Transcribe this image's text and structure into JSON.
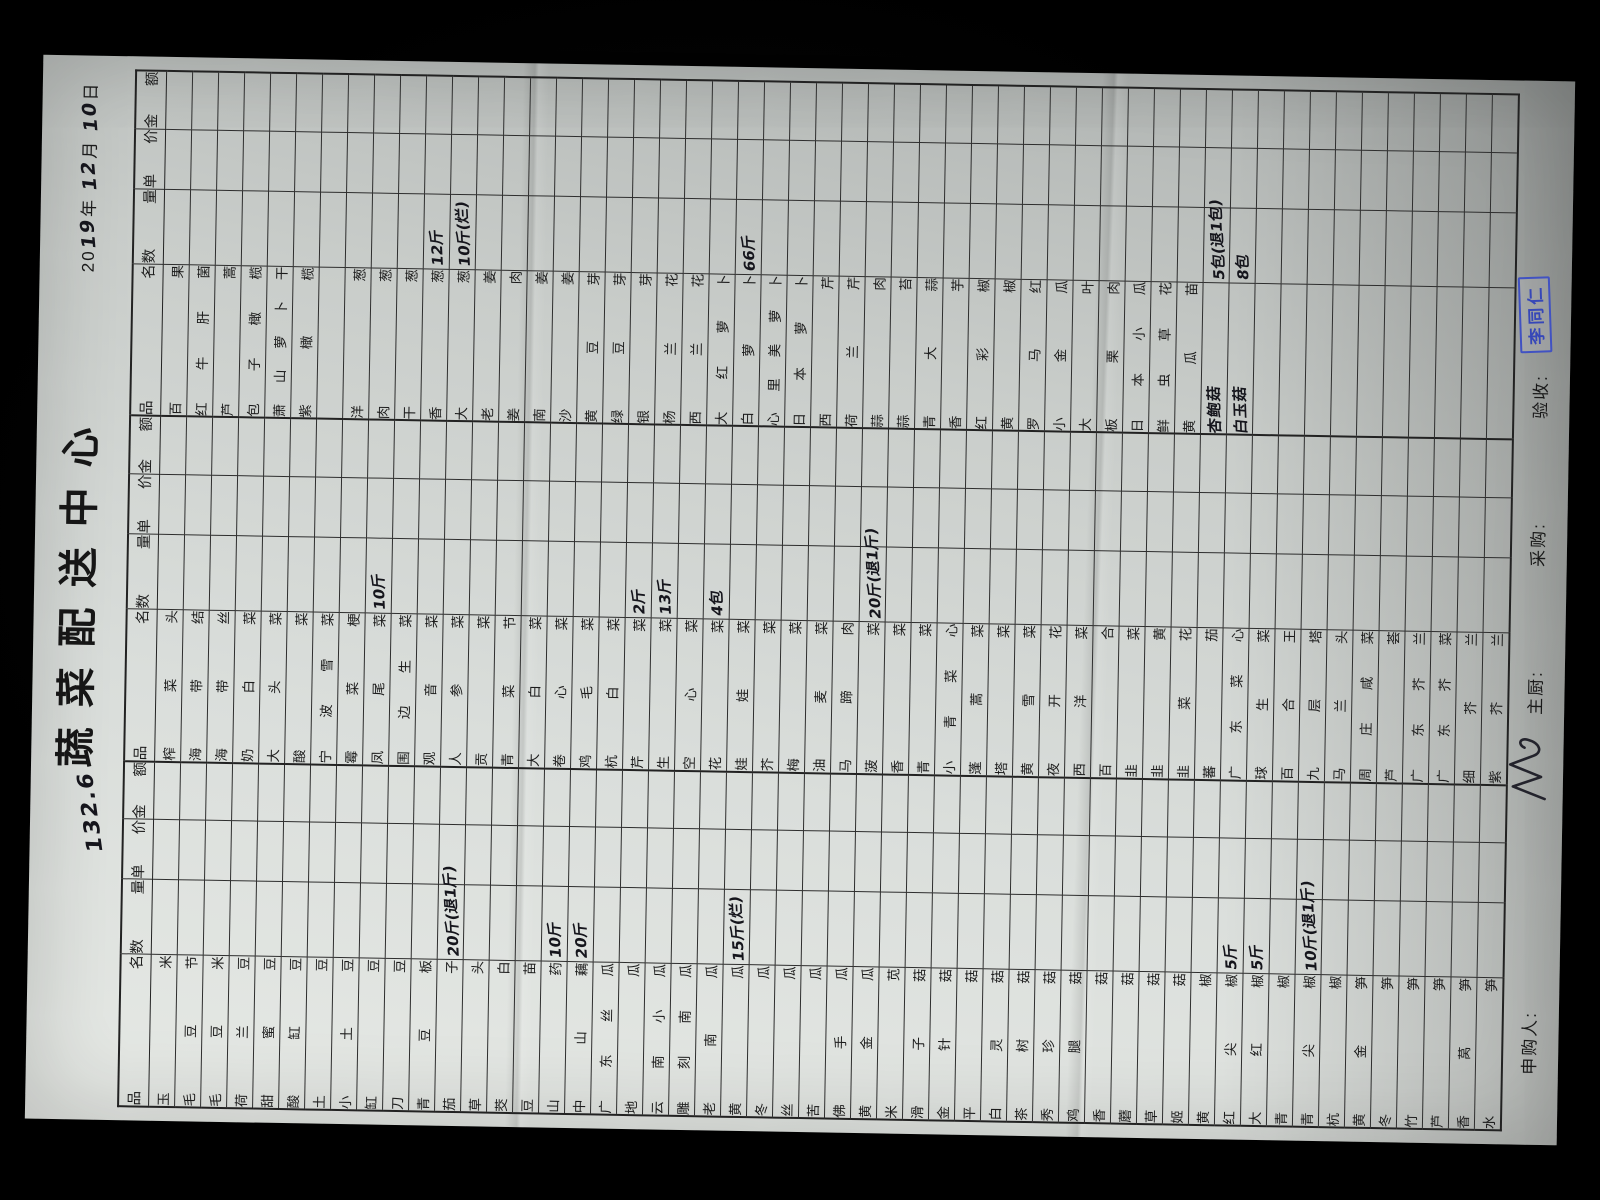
{
  "page": {
    "title": "蔬菜配送中心",
    "date": {
      "prefix": "20",
      "year_hw": "19",
      "year_unit": "年",
      "month_hw": "12",
      "month_unit": "月",
      "day_hw": "10",
      "day_unit": "日"
    },
    "total_hw": "132.6"
  },
  "table": {
    "headers": {
      "name": "品 名",
      "qty": "数量",
      "price": "单价",
      "amount": "金额"
    },
    "groups": [
      {
        "rows": [
          {
            "name": "玉米"
          },
          {
            "name": "毛豆节"
          },
          {
            "name": "毛豆米"
          },
          {
            "name": "荷兰豆"
          },
          {
            "name": "甜蜜豆"
          },
          {
            "name": "酸缸豆"
          },
          {
            "name": "土豆"
          },
          {
            "name": "小土豆"
          },
          {
            "name": "缸豆"
          },
          {
            "name": "刀豆"
          },
          {
            "name": "青豆板"
          },
          {
            "name": "茄子",
            "qty": "20斤(退1斤)"
          },
          {
            "name": "草头"
          },
          {
            "name": "茭白"
          },
          {
            "name": "豆苗"
          },
          {
            "name": "山药",
            "qty": "10斤"
          },
          {
            "name": "中山藕",
            "qty": "20斤"
          },
          {
            "name": "广东丝瓜"
          },
          {
            "name": "地瓜"
          },
          {
            "name": "云南小瓜"
          },
          {
            "name": "雕刻南瓜"
          },
          {
            "name": "老南瓜"
          },
          {
            "name": "黄瓜",
            "qty": "15斤(烂)"
          },
          {
            "name": "冬瓜"
          },
          {
            "name": "丝瓜"
          },
          {
            "name": "苦瓜"
          },
          {
            "name": "佛手瓜"
          },
          {
            "name": "黄金瓜"
          },
          {
            "name": "米苋"
          },
          {
            "name": "滑子菇"
          },
          {
            "name": "金针菇"
          },
          {
            "name": "平菇"
          },
          {
            "name": "白灵菇"
          },
          {
            "name": "茶树菇"
          },
          {
            "name": "秀珍菇"
          },
          {
            "name": "鸡腿菇"
          },
          {
            "name": "香菇"
          },
          {
            "name": "蘑菇"
          },
          {
            "name": "草菇"
          },
          {
            "name": "姬菇"
          },
          {
            "name": "黄椒"
          },
          {
            "name": "红尖椒",
            "qty": "5斤"
          },
          {
            "name": "大红椒",
            "qty": "5斤"
          },
          {
            "name": "青椒"
          },
          {
            "name": "青尖椒",
            "qty": "10斤(退1斤)"
          },
          {
            "name": "杭椒"
          },
          {
            "name": "黄金笋"
          },
          {
            "name": "冬笋"
          },
          {
            "name": "竹笋"
          },
          {
            "name": "芦笋"
          },
          {
            "name": "香莴笋"
          },
          {
            "name": "水笋"
          }
        ]
      },
      {
        "rows": [
          {
            "name": "榨菜头"
          },
          {
            "name": "海带结"
          },
          {
            "name": "海带丝"
          },
          {
            "name": "奶白菜"
          },
          {
            "name": "大头菜"
          },
          {
            "name": "酸菜"
          },
          {
            "name": "宁波雪菜"
          },
          {
            "name": "霉菜梗"
          },
          {
            "name": "凤尾菜",
            "qty": "10斤"
          },
          {
            "name": "围边生菜"
          },
          {
            "name": "观音菜"
          },
          {
            "name": "人参菜"
          },
          {
            "name": "贡菜"
          },
          {
            "name": "青菜节"
          },
          {
            "name": "大白菜"
          },
          {
            "name": "卷心菜"
          },
          {
            "name": "鸡毛菜"
          },
          {
            "name": "杭白菜"
          },
          {
            "name": "芹菜",
            "qty": "2斤"
          },
          {
            "name": "生菜",
            "qty": "13斤"
          },
          {
            "name": "空心菜"
          },
          {
            "name": "花菜",
            "qty": "4包"
          },
          {
            "name": "娃娃菜"
          },
          {
            "name": "芥菜"
          },
          {
            "name": "梅菜"
          },
          {
            "name": "油麦菜"
          },
          {
            "name": "马蹄肉"
          },
          {
            "name": "菠菜",
            "qty": "20斤(退1斤)"
          },
          {
            "name": "香菜"
          },
          {
            "name": "青菜"
          },
          {
            "name": "小青菜心"
          },
          {
            "name": "蓬蒿菜"
          },
          {
            "name": "塔菜"
          },
          {
            "name": "黄雪菜"
          },
          {
            "name": "夜开花"
          },
          {
            "name": "西洋菜"
          },
          {
            "name": "百合"
          },
          {
            "name": "韭菜"
          },
          {
            "name": "韭黄"
          },
          {
            "name": "韭菜花"
          },
          {
            "name": "蕃茄"
          },
          {
            "name": "广东菜心"
          },
          {
            "name": "球生菜"
          },
          {
            "name": "百合王"
          },
          {
            "name": "九层塔"
          },
          {
            "name": "马兰头"
          },
          {
            "name": "周庄咸菜"
          },
          {
            "name": "芦荟"
          },
          {
            "name": "广东芥兰"
          },
          {
            "name": "广东芥菜"
          },
          {
            "name": "细芥兰"
          },
          {
            "name": "紫芥兰"
          }
        ]
      },
      {
        "rows": [
          {
            "name": "百果"
          },
          {
            "name": "红牛肝菌"
          },
          {
            "name": "芦蒿"
          },
          {
            "name": "包子橄榄"
          },
          {
            "name": "萧山萝卜干"
          },
          {
            "name": "紫橄榄"
          },
          {},
          {
            "name": "洋葱"
          },
          {
            "name": "肉葱"
          },
          {
            "name": "干葱"
          },
          {
            "name": "香葱",
            "qty": "12斤"
          },
          {
            "name": "大葱",
            "qty": "10斤(烂)"
          },
          {
            "name": "老姜"
          },
          {
            "name": "姜肉"
          },
          {
            "name": "南姜"
          },
          {
            "name": "沙姜"
          },
          {
            "name": "黄豆芽"
          },
          {
            "name": "绿豆芽"
          },
          {
            "name": "银芽"
          },
          {
            "name": "杨兰花"
          },
          {
            "name": "西兰花"
          },
          {
            "name": "大红萝卜"
          },
          {
            "name": "白萝卜",
            "qty": "66斤"
          },
          {
            "name": "心里美萝卜"
          },
          {
            "name": "日本萝卜"
          },
          {
            "name": "西芹"
          },
          {
            "name": "荷兰芹"
          },
          {
            "name": "蒜肉"
          },
          {
            "name": "蒜苔"
          },
          {
            "name": "青大蒜"
          },
          {
            "name": "香芋"
          },
          {
            "name": "红彩椒"
          },
          {
            "name": "黄椒"
          },
          {
            "name": "罗马红"
          },
          {
            "name": "小金瓜"
          },
          {
            "name": "大叶"
          },
          {
            "name": "板栗肉"
          },
          {
            "name": "日本小瓜"
          },
          {
            "name": "鲜虫草花"
          },
          {
            "name": "黄瓜苗"
          },
          {
            "name": "杏鲍菇",
            "hw": true,
            "qty": "5包(退1包)"
          },
          {
            "name": "白玉菇",
            "hw": true,
            "qty": "8包"
          },
          {},
          {},
          {},
          {},
          {},
          {},
          {},
          {},
          {},
          {}
        ]
      }
    ]
  },
  "footer": {
    "requester_label": "申购人:",
    "chef_label": "主厨:",
    "purchaser_label": "采购:",
    "receiver_label": "验收:",
    "receiver_stamp": "李同仁"
  }
}
